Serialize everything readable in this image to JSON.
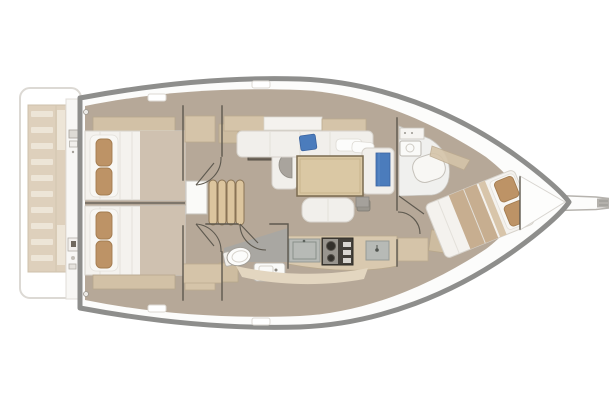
{
  "diagram": {
    "type": "floor-plan",
    "subject": "sailing-yacht-interior-top-view",
    "orientation": {
      "bow": "right",
      "stern": "left"
    },
    "regions": [
      "swim-platform",
      "transom-steps",
      "transom-instruments",
      "aft-cabin-port",
      "aft-cabin-starboard",
      "companionway-stairs",
      "nav-station",
      "saloon-settee",
      "saloon-table",
      "saloon-bench",
      "aft-head",
      "galley",
      "forward-head",
      "forward-cabin",
      "anchor-locker",
      "bowsprit"
    ]
  },
  "colors": {
    "hull_outline": "#8e8e8c",
    "hull_fill": "#fcfcfb",
    "floor_taupe": "#b6a898",
    "furn_tan": "#d5c4a9",
    "furn_tan_dark": "#cdbca0",
    "shelf_tan": "#d2c1a6",
    "table_tan": "#dac8a4",
    "table_border": "#7b6b50",
    "steps_tan": "#dcc59e",
    "steps_border": "#8a7455",
    "bed_white": "#f4f2ee",
    "bed_border": "#d6d2cb",
    "blanket": "#cfc1b0",
    "blanket_fwd": "#c7ae90",
    "pillow_tan": "#bd9366",
    "pillow_border": "#a37c50",
    "accent_blue": "#4b7cbc",
    "accent_blue_dark": "#3a63a0",
    "counter_gray": "#b7bab6",
    "counter_border": "#969b96",
    "stove_dark": "#44403a",
    "metal_gray": "#99958e",
    "wall_line": "#5e594f",
    "partition_gray": "#a9a7a2",
    "nav_desk": "#6f665a",
    "seat_gray": "#a9a49d",
    "white_fixture": "#fafaf8",
    "fixture_border": "#bcb8b1",
    "platform_white": "#ffffff",
    "platform_border": "#dcd9d4",
    "transom_tan": "#dbccb5",
    "transom_slat": "#ece3d3",
    "band_tan": "#e3d6c0",
    "sprit_gray": "#b4b1ac"
  }
}
